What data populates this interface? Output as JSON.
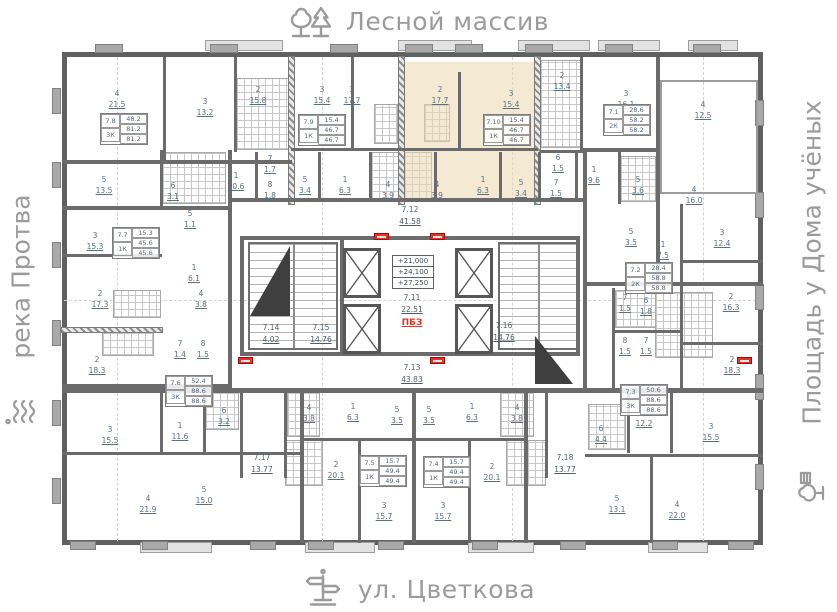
{
  "surroundings": {
    "top": {
      "label": "Лесной массив",
      "icon": "trees-icon"
    },
    "bottom": {
      "label": "ул. Цветкова",
      "icon": "signpost-icon"
    },
    "left": {
      "label": "река Протва",
      "icon": "waves-icon"
    },
    "right": {
      "label": "Площадь у Дома учёных",
      "icon": "park-icon"
    }
  },
  "colors": {
    "highlight": "#EBD9B0",
    "wall": "#6b6b6b",
    "label_text": "#5d6e7f",
    "fire_tag_red": "#e0352b",
    "street_text": "#9b9b9b"
  },
  "levels": [
    "+21,000",
    "+24,100",
    "+27,250"
  ],
  "core": {
    "pbz": "ПБЗ"
  },
  "apartments": [
    {
      "id": "7.8",
      "type": "3К",
      "living": "48.2",
      "area": "81.2",
      "total": "81.2",
      "x": 100,
      "y": 113
    },
    {
      "id": "7.9",
      "type": "1К",
      "living": "15.4",
      "area": "46.7",
      "total": "46.7",
      "x": 298,
      "y": 114
    },
    {
      "id": "7.10",
      "type": "1К",
      "living": "15.4",
      "area": "46.7",
      "total": "46.7",
      "x": 483,
      "y": 114,
      "hl": true
    },
    {
      "id": "7.1",
      "type": "2К",
      "living": "28.6",
      "area": "58.2",
      "total": "58.2",
      "x": 603,
      "y": 104
    },
    {
      "id": "7.7",
      "type": "1К",
      "living": "15.3",
      "area": "45.6",
      "total": "45.6",
      "x": 112,
      "y": 227
    },
    {
      "id": "7.2",
      "type": "2К",
      "living": "28.4",
      "area": "58.8",
      "total": "58.8",
      "x": 625,
      "y": 262
    },
    {
      "id": "7.6",
      "type": "3К",
      "living": "52.4",
      "area": "88.6",
      "total": "88.6",
      "x": 165,
      "y": 375
    },
    {
      "id": "7.3",
      "type": "3К",
      "living": "50.6",
      "area": "88.6",
      "total": "88.6",
      "x": 620,
      "y": 384
    },
    {
      "id": "7.5",
      "type": "1К",
      "living": "15.7",
      "area": "49.4",
      "total": "49.4",
      "x": 359,
      "y": 455
    },
    {
      "id": "7.4",
      "type": "1К",
      "living": "15.7",
      "area": "49.4",
      "total": "49.4",
      "x": 423,
      "y": 456
    }
  ],
  "zones": [
    {
      "id": "7.12",
      "area": "41.58",
      "x": 410,
      "y": 204
    },
    {
      "id": "7.11",
      "area": "22.51",
      "x": 412,
      "y": 292
    },
    {
      "id": "7.13",
      "area": "43.83",
      "x": 412,
      "y": 362
    },
    {
      "id": "7.14",
      "area": "4.02",
      "x": 271,
      "y": 322
    },
    {
      "id": "7.15",
      "area": "14.76",
      "x": 321,
      "y": 322
    },
    {
      "id": "7.16",
      "area": "14.76",
      "x": 504,
      "y": 320
    },
    {
      "id": "7.17",
      "area": "13.77",
      "x": 262,
      "y": 452
    },
    {
      "id": "7.18",
      "area": "13.77",
      "x": 565,
      "y": 452
    }
  ],
  "rooms": [
    {
      "n": "4",
      "a": "21.5",
      "x": 117,
      "y": 88
    },
    {
      "n": "3",
      "a": "13.2",
      "x": 205,
      "y": 96
    },
    {
      "n": "2",
      "a": "15.8",
      "x": 258,
      "y": 84
    },
    {
      "n": "3",
      "a": "15.4",
      "x": 322,
      "y": 84
    },
    {
      "n": "2",
      "a": "17.7",
      "x": 352,
      "y": 84
    },
    {
      "n": "2",
      "a": "17.7",
      "x": 440,
      "y": 84,
      "hl": true
    },
    {
      "n": "3",
      "a": "15.4",
      "x": 511,
      "y": 88,
      "hl": true
    },
    {
      "n": "2",
      "a": "13.4",
      "x": 562,
      "y": 70
    },
    {
      "n": "3",
      "a": "16.1",
      "x": 626,
      "y": 88
    },
    {
      "n": "4",
      "a": "12.5",
      "x": 703,
      "y": 99
    },
    {
      "n": "5",
      "a": "13.5",
      "x": 104,
      "y": 174
    },
    {
      "n": "6",
      "a": "3.1",
      "x": 173,
      "y": 180
    },
    {
      "n": "1",
      "a": "10.6",
      "x": 236,
      "y": 170
    },
    {
      "n": "7",
      "a": "1.7",
      "x": 270,
      "y": 153
    },
    {
      "n": "8",
      "a": "1.8",
      "x": 270,
      "y": 179
    },
    {
      "n": "5",
      "a": "3.4",
      "x": 305,
      "y": 174
    },
    {
      "n": "1",
      "a": "6.3",
      "x": 345,
      "y": 174
    },
    {
      "n": "4",
      "a": "3.9",
      "x": 388,
      "y": 179
    },
    {
      "n": "4",
      "a": "3.9",
      "x": 437,
      "y": 179,
      "hl": true
    },
    {
      "n": "1",
      "a": "6.3",
      "x": 483,
      "y": 174,
      "hl": true
    },
    {
      "n": "5",
      "a": "3.4",
      "x": 521,
      "y": 177,
      "hl": true
    },
    {
      "n": "6",
      "a": "1.5",
      "x": 558,
      "y": 152
    },
    {
      "n": "7",
      "a": "1.5",
      "x": 556,
      "y": 177
    },
    {
      "n": "1",
      "a": "9.6",
      "x": 594,
      "y": 164
    },
    {
      "n": "5",
      "a": "3.6",
      "x": 638,
      "y": 174
    },
    {
      "n": "4",
      "a": "16.0",
      "x": 694,
      "y": 184
    },
    {
      "n": "3",
      "a": "15.3",
      "x": 95,
      "y": 230
    },
    {
      "n": "5",
      "a": "1.1",
      "x": 190,
      "y": 208
    },
    {
      "n": "1",
      "a": "6.1",
      "x": 194,
      "y": 262
    },
    {
      "n": "4",
      "a": "3.8",
      "x": 201,
      "y": 288
    },
    {
      "n": "2",
      "a": "17.3",
      "x": 100,
      "y": 288
    },
    {
      "n": "2",
      "a": "18.3",
      "x": 97,
      "y": 354
    },
    {
      "n": "7",
      "a": "1.4",
      "x": 180,
      "y": 338
    },
    {
      "n": "8",
      "a": "1.5",
      "x": 203,
      "y": 338
    },
    {
      "n": "5",
      "a": "3.5",
      "x": 631,
      "y": 226
    },
    {
      "n": "1",
      "a": "7.5",
      "x": 663,
      "y": 239
    },
    {
      "n": "3",
      "a": "12.4",
      "x": 722,
      "y": 227
    },
    {
      "n": "2",
      "a": "16.3",
      "x": 731,
      "y": 291
    },
    {
      "n": "7",
      "a": "1.5",
      "x": 625,
      "y": 292
    },
    {
      "n": "6",
      "a": "1.8",
      "x": 646,
      "y": 295
    },
    {
      "n": "8",
      "a": "1.5",
      "x": 625,
      "y": 335
    },
    {
      "n": "7",
      "a": "1.5",
      "x": 646,
      "y": 335
    },
    {
      "n": "2",
      "a": "18.3",
      "x": 732,
      "y": 354
    },
    {
      "n": "3",
      "a": "15.5",
      "x": 110,
      "y": 424
    },
    {
      "n": "1",
      "a": "11.6",
      "x": 180,
      "y": 420
    },
    {
      "n": "6",
      "a": "3.2",
      "x": 224,
      "y": 405
    },
    {
      "n": "4",
      "a": "21.9",
      "x": 148,
      "y": 493
    },
    {
      "n": "5",
      "a": "15.0",
      "x": 204,
      "y": 484
    },
    {
      "n": "4",
      "a": "3.8",
      "x": 309,
      "y": 402
    },
    {
      "n": "1",
      "a": "6.3",
      "x": 353,
      "y": 401
    },
    {
      "n": "5",
      "a": "3.5",
      "x": 397,
      "y": 404
    },
    {
      "n": "5",
      "a": "3.5",
      "x": 429,
      "y": 404
    },
    {
      "n": "1",
      "a": "6.3",
      "x": 472,
      "y": 401
    },
    {
      "n": "4",
      "a": "3.8",
      "x": 517,
      "y": 402
    },
    {
      "n": "2",
      "a": "20.1",
      "x": 336,
      "y": 459
    },
    {
      "n": "2",
      "a": "20.1",
      "x": 492,
      "y": 461
    },
    {
      "n": "3",
      "a": "15.7",
      "x": 384,
      "y": 500
    },
    {
      "n": "3",
      "a": "15.7",
      "x": 443,
      "y": 500
    },
    {
      "n": "1",
      "a": "12.2",
      "x": 644,
      "y": 407
    },
    {
      "n": "6",
      "a": "4.4",
      "x": 601,
      "y": 423
    },
    {
      "n": "3",
      "a": "15.5",
      "x": 711,
      "y": 421
    },
    {
      "n": "5",
      "a": "13.1",
      "x": 617,
      "y": 493
    },
    {
      "n": "4",
      "a": "22.0",
      "x": 677,
      "y": 499
    }
  ]
}
